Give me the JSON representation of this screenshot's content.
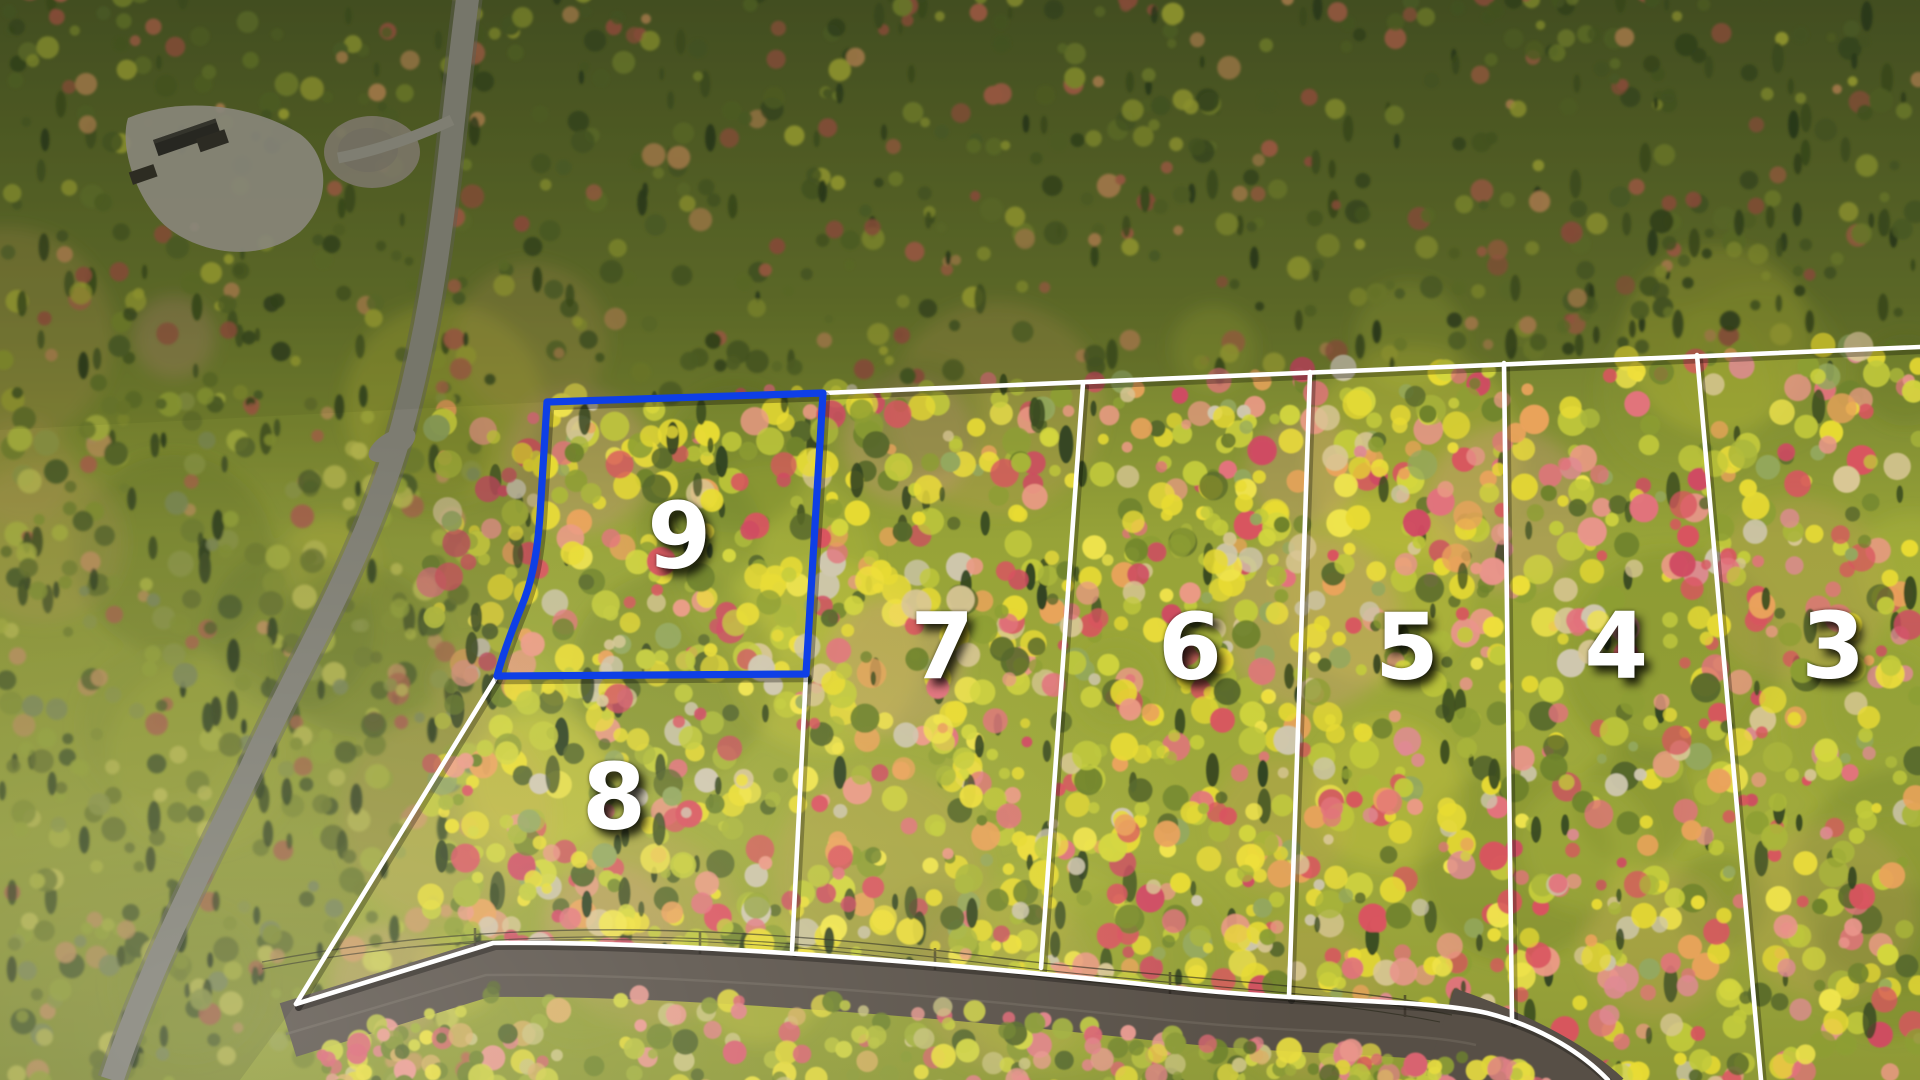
{
  "lots": [
    {
      "id": "9",
      "label": "9",
      "highlighted": true,
      "x_pct": 35.3,
      "y_pct": 50.0
    },
    {
      "id": "8",
      "label": "8",
      "highlighted": false,
      "x_pct": 31.9,
      "y_pct": 74.2
    },
    {
      "id": "7",
      "label": "7",
      "highlighted": false,
      "x_pct": 49.0,
      "y_pct": 60.3
    },
    {
      "id": "6",
      "label": "6",
      "highlighted": false,
      "x_pct": 61.9,
      "y_pct": 60.3
    },
    {
      "id": "5",
      "label": "5",
      "highlighted": false,
      "x_pct": 73.2,
      "y_pct": 60.3
    },
    {
      "id": "4",
      "label": "4",
      "highlighted": false,
      "x_pct": 84.1,
      "y_pct": 60.2
    },
    {
      "id": "3",
      "label": "3",
      "highlighted": false,
      "x_pct": 95.4,
      "y_pct": 60.2
    }
  ],
  "overlay": {
    "boundary_color": "#ffffff",
    "highlight_color": "#0e3fe6",
    "label_color": "#ffffff"
  }
}
